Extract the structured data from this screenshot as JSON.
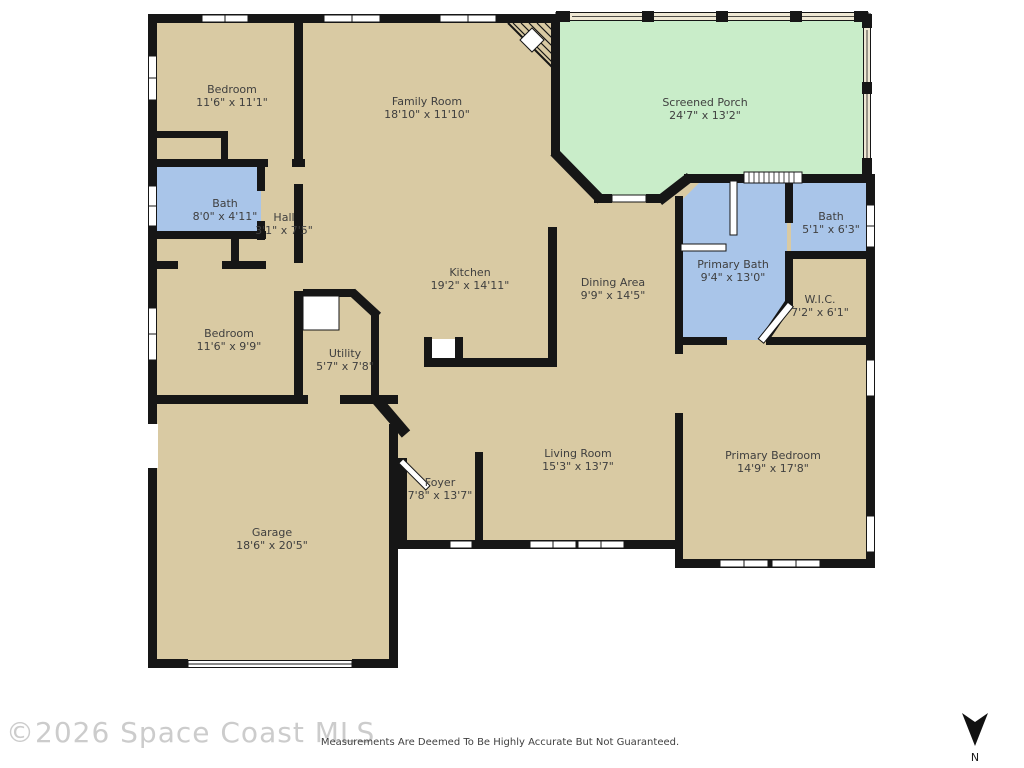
{
  "plan": {
    "rooms": [
      {
        "name": "Bedroom",
        "dims": "11'6\" x 11'1\""
      },
      {
        "name": "Family Room",
        "dims": "18'10\" x 11'10\""
      },
      {
        "name": "Screened Porch",
        "dims": "24'7\" x 13'2\""
      },
      {
        "name": "Bath",
        "dims": "8'0\" x 4'11\""
      },
      {
        "name": "Hall",
        "dims": "3'1\" x 7'5\""
      },
      {
        "name": "Bedroom",
        "dims": "11'6\" x 9'9\""
      },
      {
        "name": "Utility",
        "dims": "5'7\" x 7'8\""
      },
      {
        "name": "Kitchen",
        "dims": "19'2\" x 14'11\""
      },
      {
        "name": "Dining Area",
        "dims": "9'9\" x 14'5\""
      },
      {
        "name": "Primary Bath",
        "dims": "9'4\" x 13'0\""
      },
      {
        "name": "Bath",
        "dims": "5'1\" x 6'3\""
      },
      {
        "name": "W.I.C.",
        "dims": "7'2\" x 6'1\""
      },
      {
        "name": "Living Room",
        "dims": "15'3\" x 13'7\""
      },
      {
        "name": "Foyer",
        "dims": "7'8\" x 13'7\""
      },
      {
        "name": "Primary Bedroom",
        "dims": "14'9\" x 17'8\""
      },
      {
        "name": "Garage",
        "dims": "18'6\" x 20'5\""
      }
    ],
    "colors": {
      "floor": "#d9caa3",
      "bath": "#a9c5e9",
      "porch": "#c9edc9",
      "wall": "#161616",
      "screen_panel": "#efe8d4"
    }
  },
  "footer": {
    "watermark": "©2026 Space Coast MLS",
    "disclaimer": "Measurements Are Deemed To Be Highly Accurate But Not Guaranteed.",
    "compass_label": "N"
  }
}
